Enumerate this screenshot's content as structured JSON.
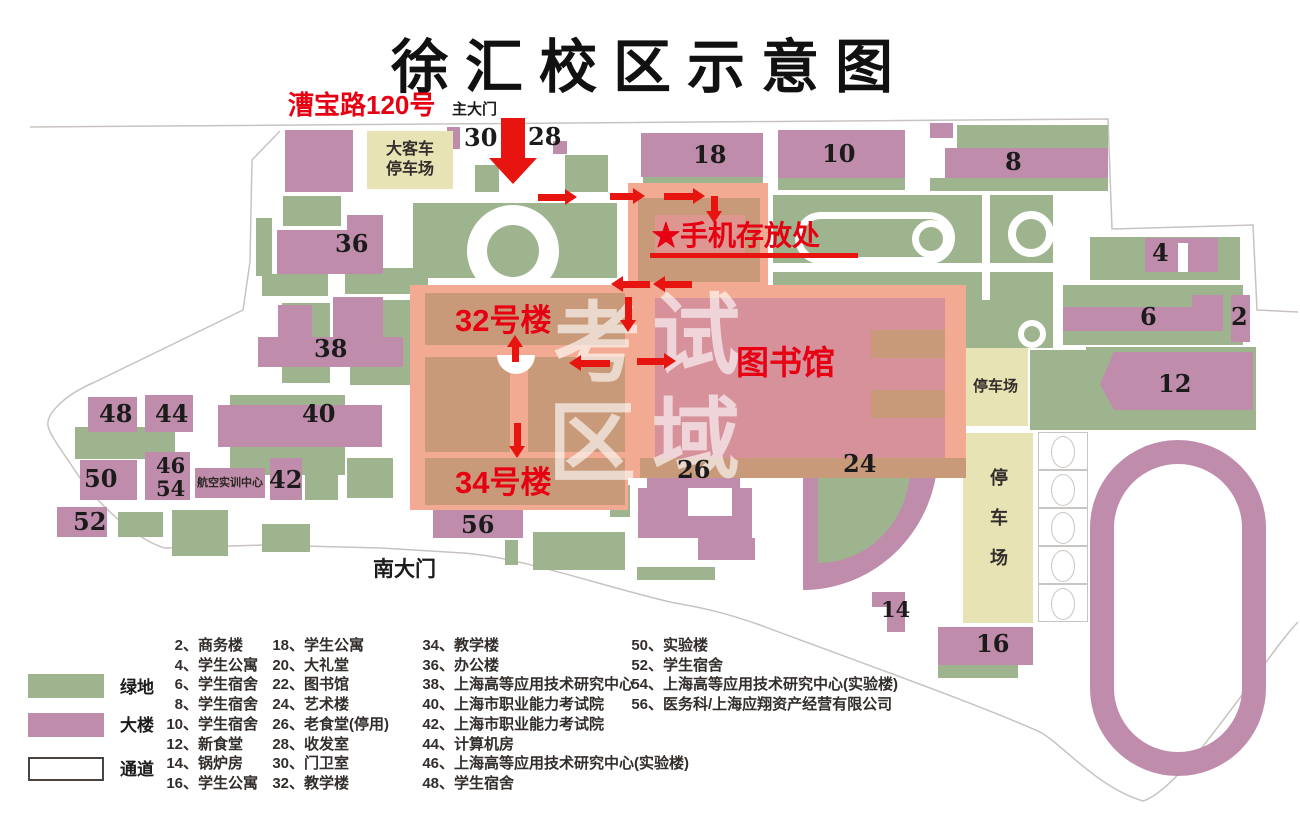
{
  "title": "徐汇校区示意图",
  "gate": {
    "address": "漕宝路120号",
    "main_gate": "主大门",
    "south_gate": "南大门"
  },
  "annotations": {
    "phone_storage": "★手机存放处",
    "building_32": "32号楼",
    "building_34": "34号楼",
    "library": "图书馆",
    "exam_chars": [
      "考",
      "试",
      "区",
      "域"
    ]
  },
  "parking": {
    "bus_line1": "大客车",
    "bus_line2": "停车场",
    "east": "停车场",
    "south": "停车场"
  },
  "aviation_center": "航空实训中心",
  "numbers": {
    "b2": "2",
    "b4": "4",
    "b6": "6",
    "b8": "8",
    "b10": "10",
    "b12": "12",
    "b14": "14",
    "b16": "16",
    "b18": "18",
    "b24": "24",
    "b26": "26",
    "b28": "28",
    "b30": "30",
    "b36": "36",
    "b38": "38",
    "b40": "40",
    "b42": "42",
    "b44": "44",
    "b46": "46",
    "b48": "48",
    "b50": "50",
    "b52": "52",
    "b54": "54",
    "b56": "56"
  },
  "legend": {
    "items": [
      {
        "label": "绿地",
        "css": "background:#9db48f"
      },
      {
        "label": "大楼",
        "css": "background:#bf8dab"
      },
      {
        "label": "通道",
        "css": "background:#ffffff;border:2px solid #4a4440"
      }
    ]
  },
  "directory": {
    "columns": [
      [
        {
          "num": "2、",
          "name": "商务楼"
        },
        {
          "num": "4、",
          "name": "学生公寓"
        },
        {
          "num": "6、",
          "name": "学生宿舍"
        },
        {
          "num": "8、",
          "name": "学生宿舍"
        },
        {
          "num": "10、",
          "name": "学生宿舍"
        },
        {
          "num": "12、",
          "name": "新食堂"
        },
        {
          "num": "14、",
          "name": "锅炉房"
        },
        {
          "num": "16、",
          "name": "学生公寓"
        }
      ],
      [
        {
          "num": "18、",
          "name": "学生公寓"
        },
        {
          "num": "20、",
          "name": "大礼堂"
        },
        {
          "num": "22、",
          "name": "图书馆"
        },
        {
          "num": "24、",
          "name": "艺术楼"
        },
        {
          "num": "26、",
          "name": "老食堂(停用)"
        },
        {
          "num": "28、",
          "name": "收发室"
        },
        {
          "num": "30、",
          "name": "门卫室"
        },
        {
          "num": "32、",
          "name": "教学楼"
        }
      ],
      [
        {
          "num": "34、",
          "name": "教学楼"
        },
        {
          "num": "36、",
          "name": "办公楼"
        },
        {
          "num": "38、",
          "name": "上海高等应用技术研究中心"
        },
        {
          "num": "40、",
          "name": "上海市职业能力考试院"
        },
        {
          "num": "42、",
          "name": "上海市职业能力考试院"
        },
        {
          "num": "44、",
          "name": "计算机房"
        },
        {
          "num": "46、",
          "name": "上海高等应用技术研究中心(实验楼)"
        },
        {
          "num": "48、",
          "name": "学生宿舍"
        }
      ],
      [
        {
          "num": "50、",
          "name": "实验楼"
        },
        {
          "num": "52、",
          "name": "学生宿舍"
        },
        {
          "num": "54、",
          "name": "上海高等应用技术研究中心(实验楼)"
        },
        {
          "num": "56、",
          "name": "医务科/上海应翔资产经营有限公司"
        }
      ]
    ]
  },
  "colors": {
    "green": "#9db48f",
    "building_pink": "#bf8dab",
    "passage": "#ffffff",
    "parking_beige": "#e8e3b5",
    "exam_overlay": "#f2ab92",
    "exam_building_tan": "#c89a79",
    "library_rose": "#d6919b",
    "red": "#e8140f"
  }
}
